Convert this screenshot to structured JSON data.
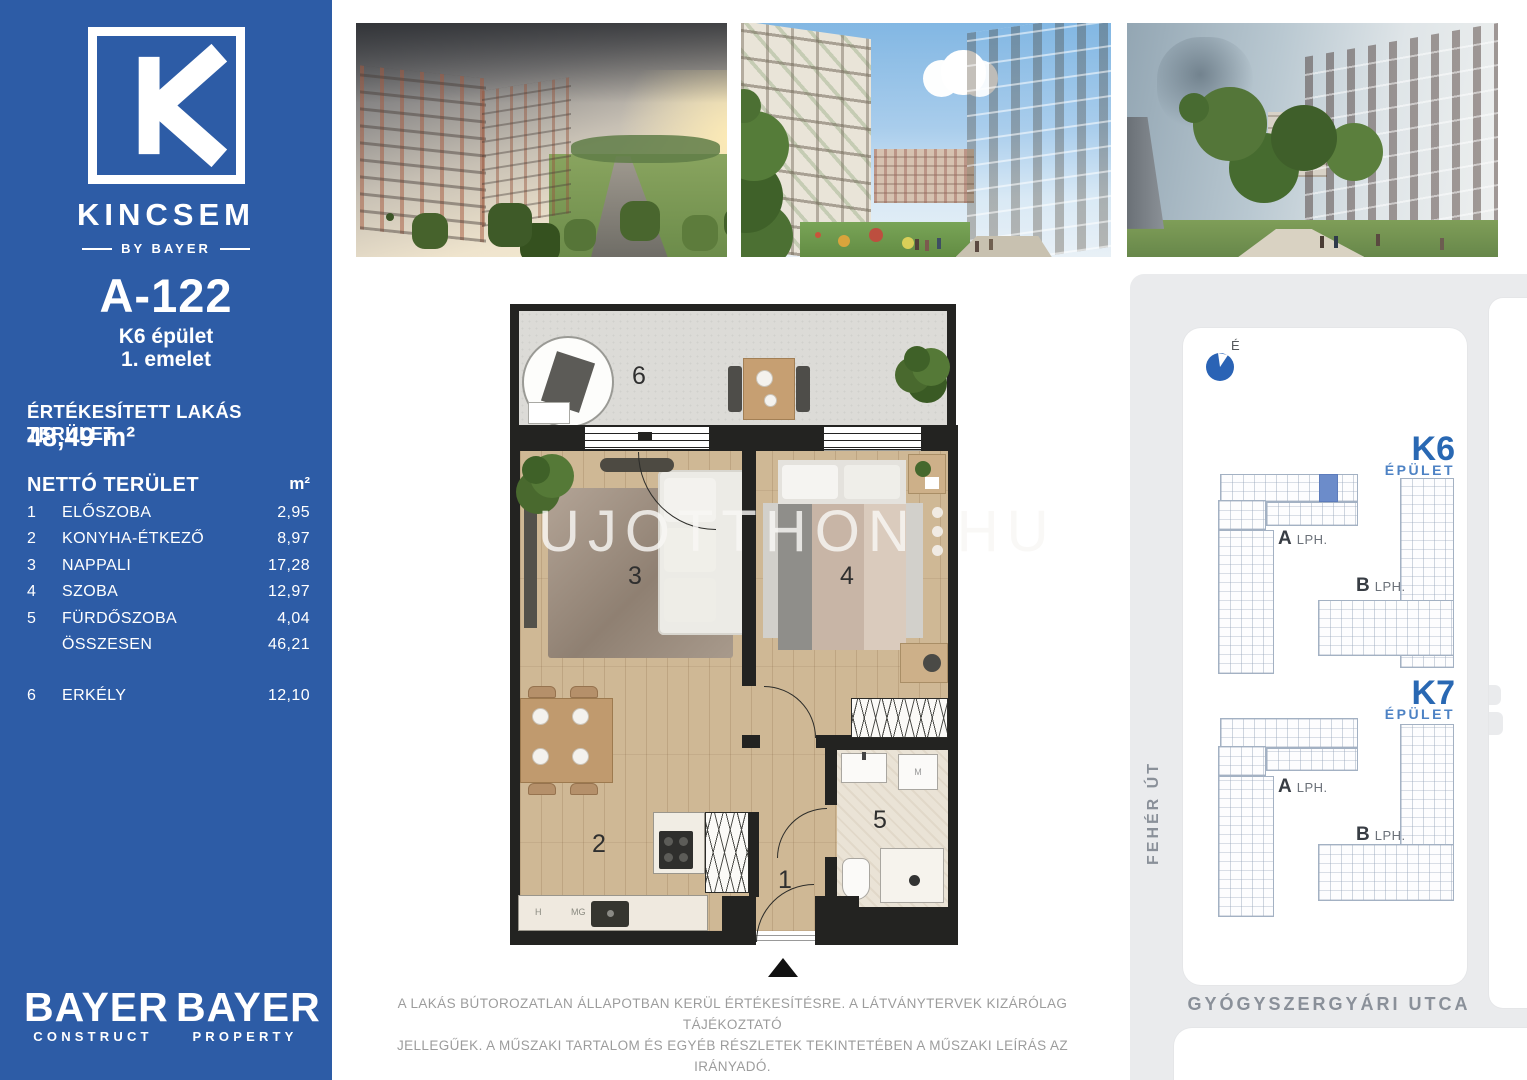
{
  "colors": {
    "sidebar_blue": "#2d5ca6",
    "accent_blue": "#2968b3",
    "unit_highlight": "#6c8cca",
    "wall_black": "#232321"
  },
  "sidebar": {
    "brand_name": "KINCSEM",
    "brand_by": "BY BAYER",
    "unit_code": "A-122",
    "building": "K6 épület",
    "floor": "1. emelet",
    "sold_title": "ÉRTÉKESÍTETT LAKÁS TERÜLET",
    "sold_value": "48,49 m²",
    "net_title": "NETTÓ TERÜLET",
    "net_unit": "m²",
    "rows": [
      {
        "num": "1",
        "name": "ELŐSZOBA",
        "value": "2,95"
      },
      {
        "num": "2",
        "name": "KONYHA-ÉTKEZŐ",
        "value": "8,97"
      },
      {
        "num": "3",
        "name": "NAPPALI",
        "value": "17,28"
      },
      {
        "num": "4",
        "name": "SZOBA",
        "value": "12,97"
      },
      {
        "num": "5",
        "name": "FÜRDŐSZOBA",
        "value": "4,04"
      },
      {
        "num": "",
        "name": "ÖSSZESEN",
        "value": "46,21"
      },
      {
        "num": "6",
        "name": "ERKÉLY",
        "value": "12,10"
      }
    ],
    "logo1_title": "BAYER",
    "logo1_sub": "CONSTRUCT",
    "logo2_title": "BAYER",
    "logo2_sub": "PROPERTY"
  },
  "floorplan": {
    "numbers": {
      "hall": "1",
      "kitchen": "2",
      "living": "3",
      "bedroom": "4",
      "bath": "5",
      "balcony": "6"
    },
    "labels": {
      "hood": "H",
      "mg": "MG",
      "washer": "M"
    },
    "watermark_left": "UJOTTHON",
    "watermark_right": "HU"
  },
  "siteplan": {
    "north": "É",
    "k6": {
      "title": "K6",
      "subtitle": "ÉPÜLET",
      "a": "A",
      "a_sub": "LPH.",
      "b": "B",
      "b_sub": "LPH."
    },
    "k7": {
      "title": "K7",
      "subtitle": "ÉPÜLET",
      "a": "A",
      "a_sub": "LPH.",
      "b": "B",
      "b_sub": "LPH."
    },
    "street_left": "FEHÉR ÚT",
    "street_bottom": "GYÓGYSZERGYÁRI UTCA"
  },
  "disclaimer_line1": "A LAKÁS BÚTOROZATLAN ÁLLAPOTBAN KERÜL ÉRTÉKESÍTÉSRE. A LÁTVÁNYTERVEK KIZÁRÓLAG TÁJÉKOZTATÓ",
  "disclaimer_line2": "JELLEGŰEK. A MŰSZAKI TARTALOM ÉS EGYÉB RÉSZLETEK TEKINTETÉBEN A MŰSZAKI LEÍRÁS AZ IRÁNYADÓ."
}
